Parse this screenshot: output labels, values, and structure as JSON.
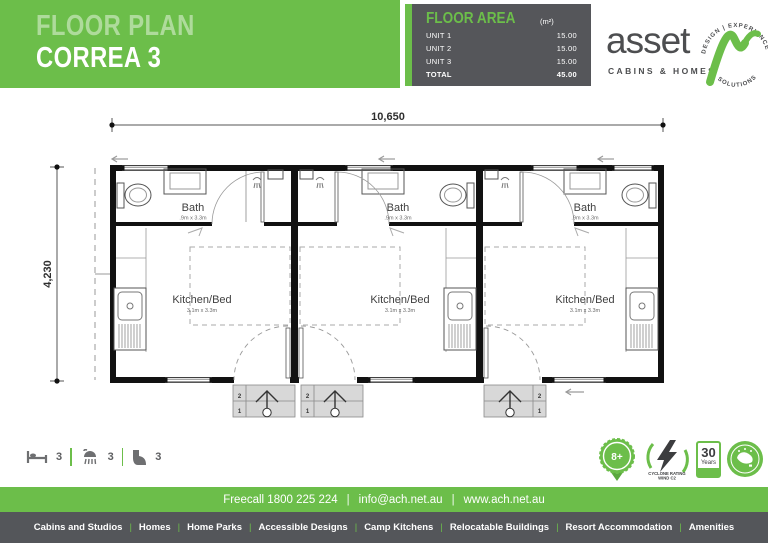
{
  "header": {
    "title_line1": "FLOOR PLAN",
    "title_line2": "CORREA 3"
  },
  "floor_area": {
    "title": "FLOOR AREA",
    "unit": "(m²)",
    "rows": [
      {
        "label": "UNIT 1",
        "value": "15.00"
      },
      {
        "label": "UNIT 2",
        "value": "15.00"
      },
      {
        "label": "UNIT 3",
        "value": "15.00"
      },
      {
        "label": "TOTAL",
        "value": "45.00"
      }
    ]
  },
  "logo": {
    "name": "asset",
    "tagline": "CABINS & HOMES",
    "ring_top": "DESIGN | EXPERIENCE",
    "ring_bottom": "SOLUTIONS",
    "accent_color": "#6cbe4a"
  },
  "plan": {
    "overall_width": "10,650",
    "overall_height": "4,230",
    "units": [
      {
        "bath_label": "Bath",
        "bath_dims": ".9m x 3.3m",
        "room_label": "Kitchen/Bed",
        "room_dims": "3.1m x 3.3m",
        "step_top": "2",
        "step_bottom": "1"
      },
      {
        "bath_label": "Bath",
        "bath_dims": ".9m x 3.3m",
        "room_label": "Kitchen/Bed",
        "room_dims": "3.1m x 3.3m",
        "step_top": "2",
        "step_bottom": "1"
      },
      {
        "bath_label": "Bath",
        "bath_dims": ".9m x 3.3m",
        "room_label": "Kitchen/Bed",
        "room_dims": "3.1m x 3.3m",
        "step_top": "2",
        "step_bottom": "1"
      }
    ]
  },
  "legend": {
    "bed_count": "3",
    "shower_count": "3",
    "toilet_count": "3"
  },
  "badges": {
    "warranty": "8+",
    "cyclone_line1": "CYCLONE RATING",
    "cyclone_line2": "WIND C2",
    "years_number": "30",
    "years_word": "Years"
  },
  "contact": {
    "separator": "|",
    "items": [
      "Freecall 1800 225 224",
      "info@ach.net.au",
      "www.ach.net.au"
    ]
  },
  "nav": {
    "separator": "|",
    "items": [
      "Cabins and Studios",
      "Homes",
      "Home Parks",
      "Accessible Designs",
      "Camp Kitchens",
      "Relocatable Buildings",
      "Resort Accommodation",
      "Amenities"
    ]
  },
  "colors": {
    "brand_green": "#6cbe4a",
    "dark_gray": "#54565a"
  }
}
